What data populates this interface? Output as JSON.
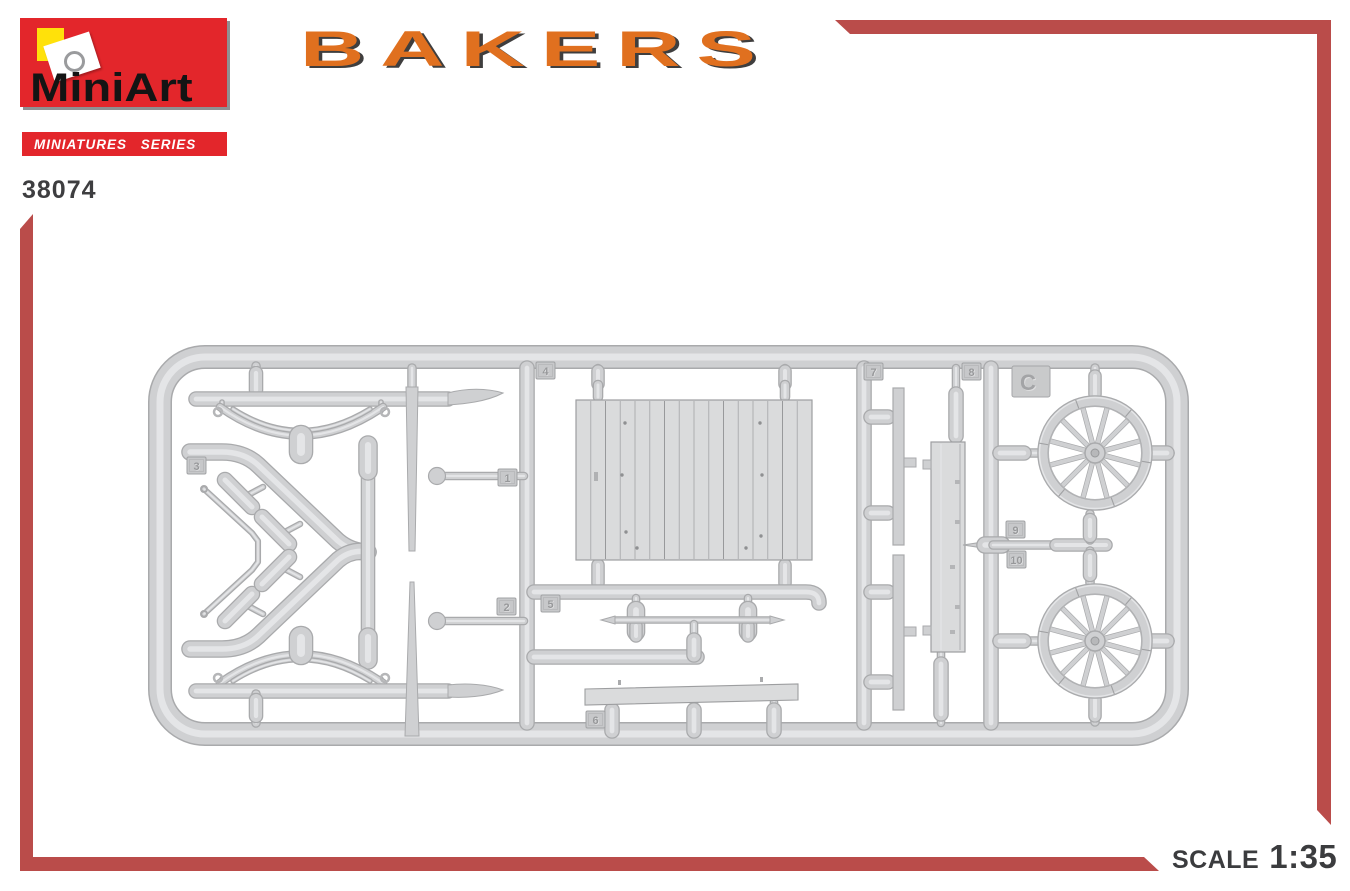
{
  "brand": {
    "name": "MiniArt",
    "series_label": "MINIATURES SERIES",
    "product_code": "38074"
  },
  "title": "BAKERS",
  "scale": {
    "label": "SCALE",
    "value": "1:35"
  },
  "sprue": {
    "letter_badge": "C",
    "part_tags": [
      {
        "label": "3",
        "x": 187,
        "y": 457
      },
      {
        "label": "1",
        "x": 498,
        "y": 469
      },
      {
        "label": "2",
        "x": 497,
        "y": 598
      },
      {
        "label": "4",
        "x": 536,
        "y": 362
      },
      {
        "label": "5",
        "x": 541,
        "y": 595
      },
      {
        "label": "6",
        "x": 586,
        "y": 711
      },
      {
        "label": "7",
        "x": 864,
        "y": 363
      },
      {
        "label": "8",
        "x": 962,
        "y": 363
      },
      {
        "label": "9",
        "x": 1006,
        "y": 521
      },
      {
        "label": "10",
        "x": 1007,
        "y": 551
      }
    ]
  },
  "colors": {
    "brand_red": "#e3262b",
    "logo_yellow": "#ffe10a",
    "title_orange": "#e0701f",
    "title_shadow": "#3f3e3e",
    "frame_red": "#ba4c4a",
    "text_dark": "#3e3e40",
    "sprue_edge": "#a9aaac",
    "sprue_base": "#cfd0d2",
    "sprue_light": "#e4e5e7",
    "panel_fill": "#dadbdc",
    "panel_line": "#9d9ea0"
  }
}
